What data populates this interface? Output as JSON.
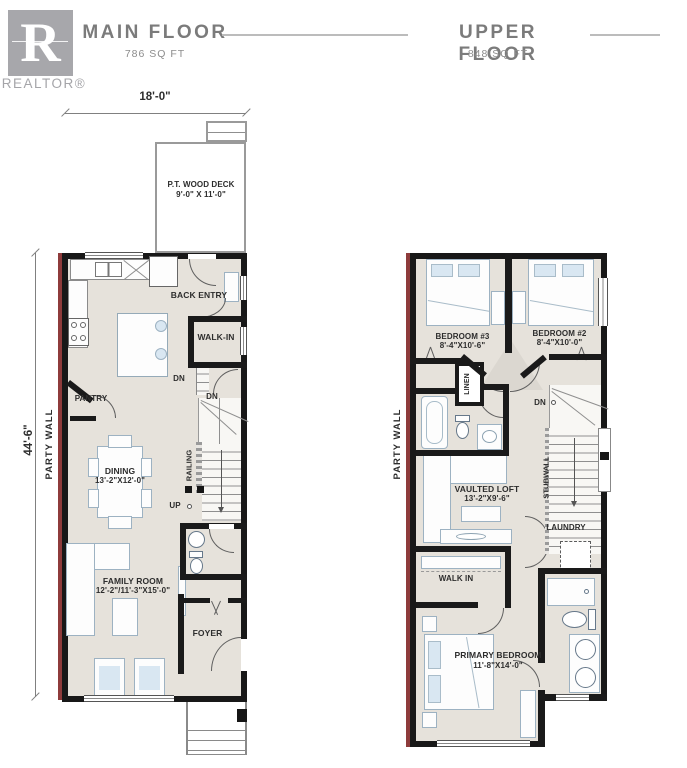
{
  "header": {
    "logo_letter": "R",
    "logo_brand": "REALTOR®",
    "floors": [
      {
        "title": "MAIN FLOOR",
        "area": "786 SQ FT"
      },
      {
        "title": "UPPER FLOOR",
        "area": "848 SQ FT"
      }
    ]
  },
  "main_floor": {
    "dim_width": "18'-0\"",
    "dim_height": "44'-6\"",
    "party_wall": "PARTY WALL",
    "deck_name": "P.T. WOOD DECK",
    "deck_dims": "9'-0\" X 11'-0\"",
    "back_entry": "BACK ENTRY",
    "walk_in": "WALK-IN",
    "pantry": "PANTRY",
    "dn_back": "DN",
    "dn_stairs": "DN",
    "railing": "RAILING",
    "up": "UP",
    "dining_name": "DINING",
    "dining_dims": "13'-2\"X12'-0\"",
    "family_name": "FAMILY ROOM",
    "family_dims": "12'-2\"/11'-3\"X15'-0\"",
    "foyer": "FOYER"
  },
  "upper_floor": {
    "party_wall": "PARTY WALL",
    "bedroom3_name": "BEDROOM #3",
    "bedroom3_dims": "8'-4\"X10'-6\"",
    "bedroom2_name": "BEDROOM #2",
    "bedroom2_dims": "8'-4\"X10'-0\"",
    "linen": "LINEN",
    "dn": "DN",
    "stubwall": "STUBWALL",
    "loft_name": "VAULTED LOFT",
    "loft_dims": "13'-2\"X9'-6\"",
    "laundry": "LAUNDRY",
    "walk_in": "WALK IN",
    "primary_name": "PRIMARY BEDROOM",
    "primary_dims": "11'-8\"X14'-0\""
  },
  "colors": {
    "wall": "#1a1a1a",
    "floor_fill": "#e6e2db",
    "party_wall_red": "#8e3b3b",
    "furniture_line": "#9db2c2",
    "furniture_accent": "#d9e7f2",
    "title_gray": "#7b7b7b",
    "logo_gray": "#a7a7ab"
  }
}
